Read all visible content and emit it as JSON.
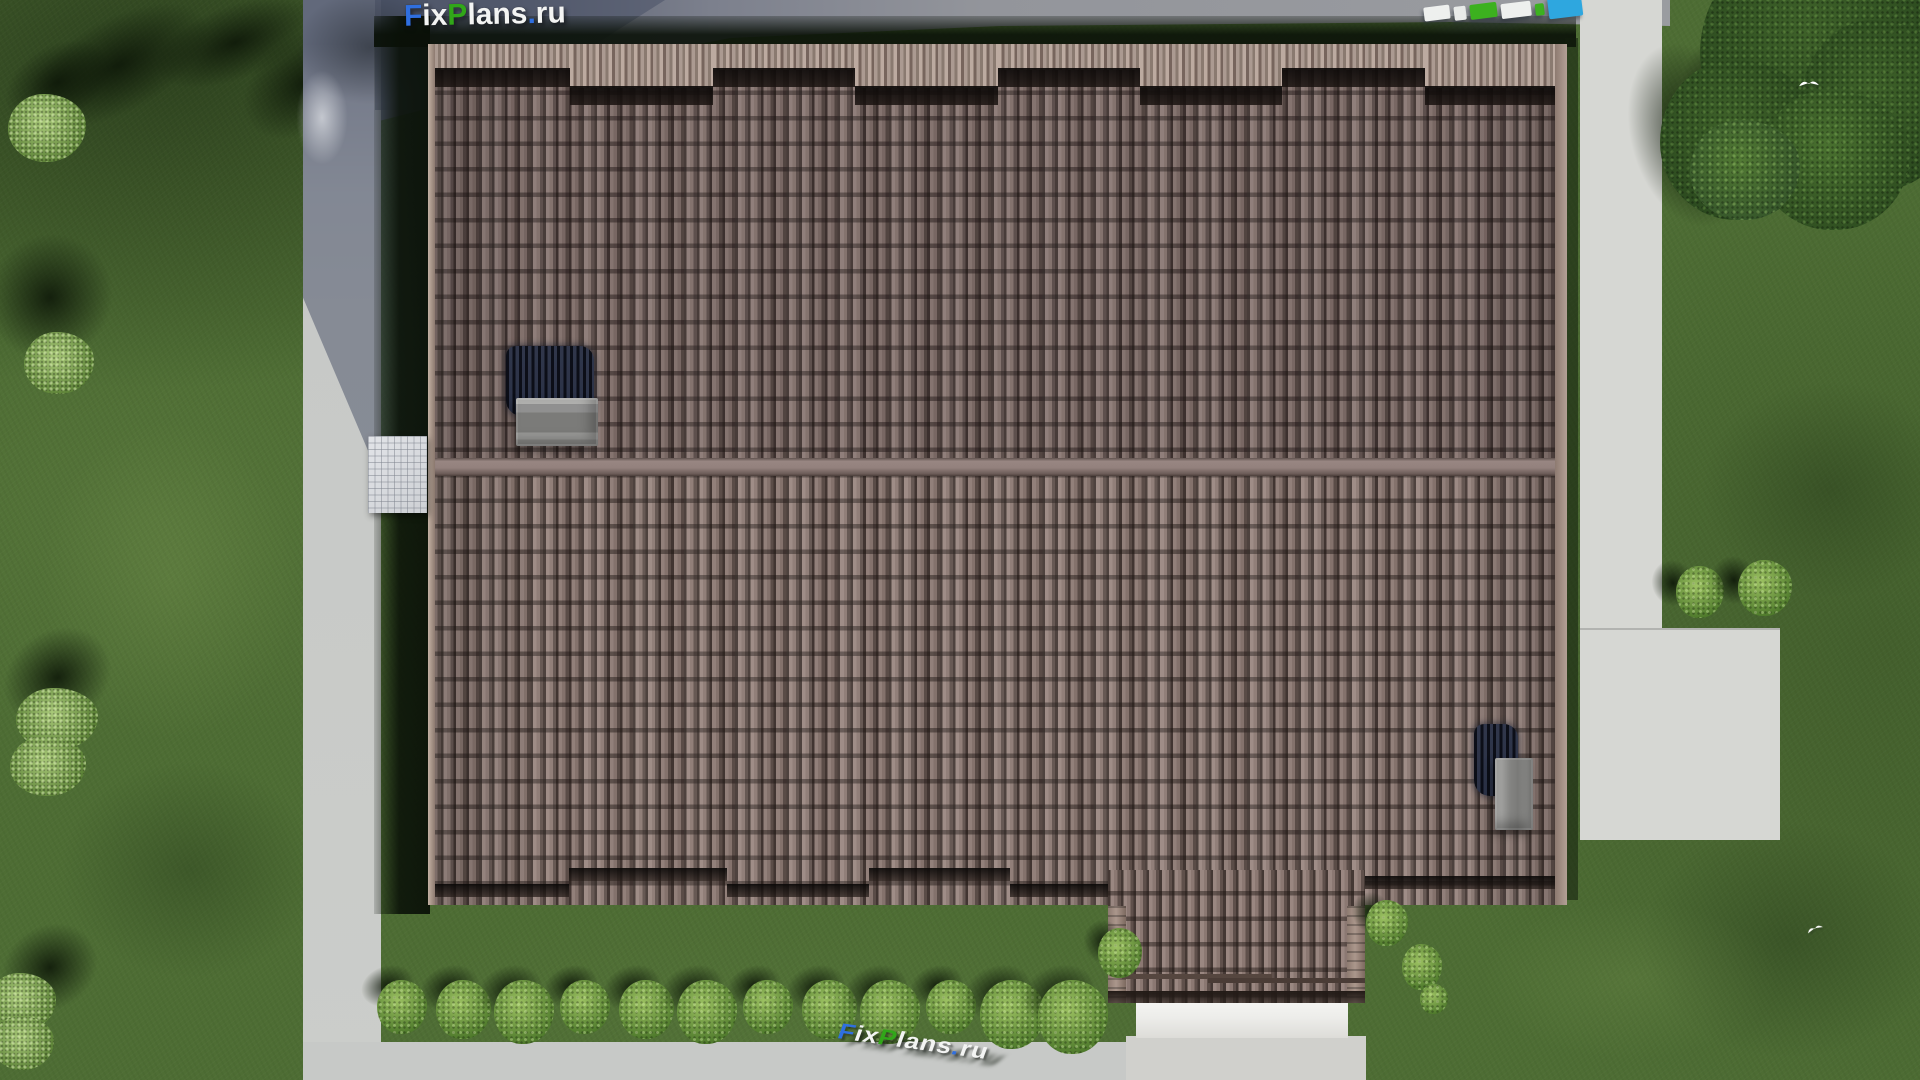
{
  "scene": {
    "title": "Aerial top-down 3D render of a house with a brown tiled roof, lawn, paths and trees",
    "watermark": {
      "site": "FixPlans.ru",
      "segments": [
        {
          "text": "F",
          "color": "#2f6fe0"
        },
        {
          "text": "ix",
          "color": "#f3f4f3"
        },
        {
          "text": "P",
          "color": "#31a719"
        },
        {
          "text": "lans",
          "color": "#f3f4f3"
        },
        {
          "text": ".",
          "color": "#2f6fe0"
        },
        {
          "text": "ru",
          "color": "#f3f4f3"
        }
      ]
    },
    "watermark_top_blocks": [
      {
        "color": "#eef0ee",
        "width": 26,
        "height": 14,
        "offset": 4
      },
      {
        "color": "#e9ebe9",
        "width": 12,
        "height": 14,
        "offset": 7
      },
      {
        "color": "#3cb11f",
        "width": 27,
        "height": 15,
        "offset": 7
      },
      {
        "color": "#eef0ee",
        "width": 30,
        "height": 15,
        "offset": 10
      },
      {
        "color": "#3cb11f",
        "width": 9,
        "height": 12,
        "offset": 14
      },
      {
        "color": "#2ea7df",
        "width": 34,
        "height": 22,
        "offset": 9
      }
    ],
    "hedge": {
      "count": 12,
      "start_x": 402,
      "step_x": 61,
      "y": 980
    },
    "palette": {
      "grass": "#4e6d34",
      "grass_shadow": "#15240e",
      "tile_light": "#9a8781",
      "tile_mid": "#8b7872",
      "tile_gap": "#443834",
      "tile_cap": "#b3a096",
      "ridge": "#93817d",
      "road": "#c7c9c7",
      "road_shadow": "#60677a",
      "concrete": "#d6d7d3",
      "canopy": "#ededea",
      "chimney": "#909090",
      "vent_dark": "#262b39",
      "bush_light": "#9cc162",
      "bush_dark": "#4f7a2c",
      "tree_dark": "#2a481e",
      "bird": "#ffffff"
    }
  }
}
